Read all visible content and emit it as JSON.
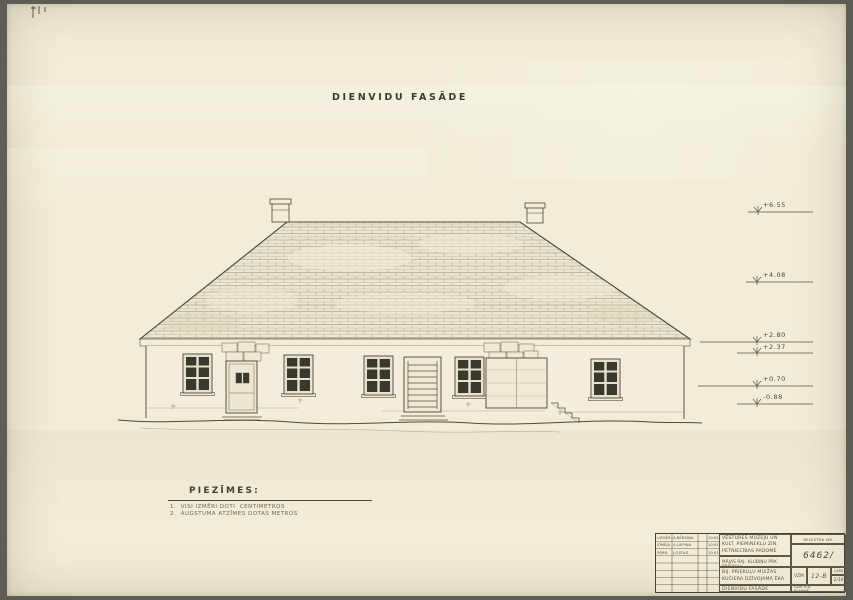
{
  "sheet": {
    "title": "DIENVIDU FASĀDE",
    "notes": {
      "heading": "PIEZĪMES:",
      "items": [
        "1.  VISI IZMĒRI DOTI  CENTIMETROS",
        "2.  AUGSTUMA ATZĪMES DOTAS METROS"
      ]
    },
    "elevation_marks": [
      {
        "label": "+6.55"
      },
      {
        "label": "+4.08"
      },
      {
        "label": "+2.80"
      },
      {
        "label": "+2.37"
      },
      {
        "label": "+0.70"
      },
      {
        "label": "-0.88"
      }
    ]
  },
  "title_block": {
    "institution_line1": "VĒSTURES MUZEJU UN",
    "institution_line2": "KULT. PIEMINEKĻU ZIN.",
    "institution_line3": "PĒTNIECĪBAS PADOME",
    "project": "MĀJAS RAJ. KLUBIŅU PRK PRIEKUĻI",
    "object_line1": "BIJ. PRIEKUĻU MUIŽAS",
    "object_line2": "KUČIERA DZĪVOJAMĀ ĒKA",
    "sheet_name": "DIENVIDU FASĀDE",
    "register_label": "REĢISTRA NR.",
    "register_number": "6462/",
    "code": "VZM",
    "drawing_code": "12-B",
    "sheet_label": "LAPA",
    "sheet_number": "1/16",
    "checked_line1": "UZM. K.K.",
    "checked_line2": "KĻAVIŅŠ",
    "personnel": [
      {
        "role": "UZMĒR.",
        "name": "A.BĒRZIŅA",
        "date": "10.61"
      },
      {
        "role": "ZĪMĒJA",
        "name": "A.LIEPIŅA",
        "date": "10.61"
      },
      {
        "role": "PĀRB.",
        "name": "J.OZOLS",
        "date": "10.61"
      }
    ]
  },
  "colors": {
    "paper": "#f1edd9",
    "ink": "#4a463a",
    "glass": "#3a382d",
    "background": "#5d5d55"
  }
}
